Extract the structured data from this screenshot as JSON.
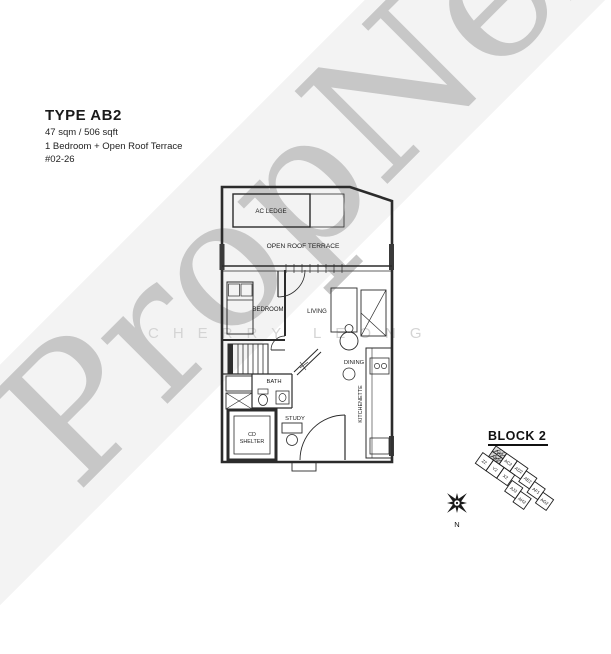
{
  "watermark": {
    "brand": "PropNex",
    "agent": "CHERRY LEONG"
  },
  "header": {
    "type_label": "TYPE AB2",
    "area": "47 sqm / 506 sqft",
    "description": "1 Bedroom + Open Roof Terrace",
    "unit_number": "#02-26"
  },
  "floorplan": {
    "labels": {
      "ac_ledge": "AC LEDGE",
      "terrace": "OPEN ROOF TERRACE",
      "bedroom": "BEDROOM",
      "living": "LIVING",
      "dining": "DINING",
      "bath": "BATH",
      "study": "STUDY",
      "kitchenette": "KITCHENETTE",
      "cd_line1": "CD",
      "cd_line2": "SHELTER"
    }
  },
  "keyplan": {
    "title": "BLOCK 2",
    "highlighted_unit": "AB2",
    "units": [
      "AA2",
      "AB2",
      "AC2",
      "AD2",
      "AE2",
      "AF1",
      "AG2",
      "Z2",
      "Y2",
      "X2",
      "AJ2",
      "AH2"
    ],
    "compass_label": "N"
  },
  "colors": {
    "watermark_gray": "#c7c7c7",
    "agent_gray": "#d4d4d4",
    "line_black": "#2b2b2b"
  }
}
